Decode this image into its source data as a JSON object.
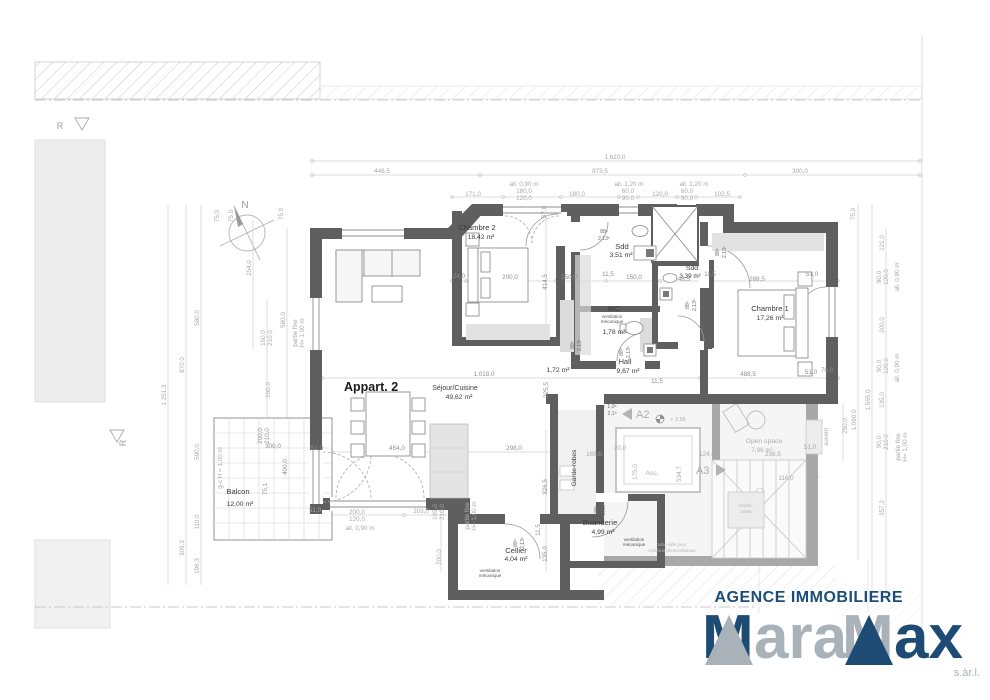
{
  "branding": {
    "agency": "AGENCE IMMOBILIERE",
    "logo_m1": "M",
    "logo_mid": "ara",
    "logo_m2": "M",
    "logo_end": "ax",
    "suffix": "s.àr.l.",
    "navy": "#1d4b74",
    "silver": "#a9b2b9"
  },
  "colors": {
    "wall": "#5f5f5f",
    "common_wall": "#a3a3a3",
    "dim_text": "#a9a9a9",
    "accent_navy": "#1c4d78"
  },
  "compass": {
    "north": "N"
  },
  "site": {
    "r_marker1": "R",
    "r_marker2": "R"
  },
  "rooms": {
    "apartment": "Appart. 2",
    "sejour": {
      "name": "Séjour/Cuisine",
      "area": "49,62 m²"
    },
    "chambre2": {
      "name": "Chambre 2",
      "area": "18,42 m²"
    },
    "sdd1": {
      "name": "Sdd",
      "area": "3,51 m²"
    },
    "sdd2": {
      "name": "Sdd",
      "area": "3,39 m²"
    },
    "wc": {
      "name": "WC",
      "area": "1,78 m²",
      "note1": "ventilation",
      "note2": "mécanique"
    },
    "hall": {
      "name": "Hall",
      "area": "9,67 m²"
    },
    "small": {
      "area": "1,72 m²"
    },
    "chambre1": {
      "name": "Chambre 1",
      "area": "17,26 m²"
    },
    "balcon": {
      "name": "Balcon",
      "area": "12,00 m²"
    },
    "garde": {
      "name": "Garde-robes"
    },
    "buanderie": {
      "name": "Buanderie",
      "area": "4,99 m²",
      "note1": "ventilation",
      "note2": "mécanique"
    },
    "cellier": {
      "name": "Cellier",
      "area": "4,04 m²",
      "note1": "ventilation",
      "note2": "mécanique"
    },
    "open_space": {
      "name": "Open space",
      "area": "7,96 m²"
    },
    "asc": "Asc.",
    "garde2a": "Garde-",
    "garde2b": "robes",
    "auvent": "auvent",
    "level": "+ 2,95",
    "marker_a2": "A2",
    "marker_a3": "A3",
    "photo1": "tube vide pour",
    "photo2": "système photovoltaique"
  },
  "ann": {
    "w1": "88⁵",
    "h1": "2,13⁵",
    "w2": "1,0⁵",
    "h2": "2,1³"
  },
  "dims": {
    "t1": "1.620,0",
    "t2": "446,5",
    "t3": "873,5",
    "t4": "300,0",
    "t5": "all. 0,90 m",
    "t6": "180,0",
    "t7": "120,0",
    "t8": "171,0",
    "t9": "180,0",
    "t10": "all. 1,20 m",
    "t11": "60,0",
    "t12": "90,0",
    "t13": "120,0",
    "t14": "all. 1,20 m",
    "t15": "60,0",
    "t16": "90,0",
    "t17": "102,5",
    "l1": "75,0",
    "l2": "75,0",
    "l3": "75,0",
    "l4": "1.251,3",
    "l5": "870,0",
    "l6": "580,0",
    "l7": "254,0",
    "l8": "580,0",
    "l9": "160,0",
    "l10": "210,0",
    "l11": "partie fixe",
    "l12": "H= 1,00 m",
    "l13": "160,0",
    "l14": "590,0",
    "l15": "110,0",
    "l16": "306,3",
    "l17": "196,3",
    "b1": "300,0",
    "b2": "200,0",
    "b3": "210,0",
    "b4": "400,0",
    "b5": "75,1",
    "b6": "51,0",
    "b7": "g-c H = 1,00 m",
    "b8": "51,0",
    "b9": "200,0",
    "b10": "120,0",
    "b11": "all. 0,90 m",
    "m1": "24,0",
    "m2": "200,0",
    "m3": "414,5",
    "m4": "250,0",
    "m5": "11,5",
    "m6": "150,0",
    "m7": "48,5",
    "m8": "11,5",
    "m9": "288,5",
    "m10": "51,0",
    "m11": "70,0",
    "m12": "57,0",
    "m13": "1.018,0",
    "m14": "225,5",
    "m15": "488,5",
    "m16": "11,5",
    "g1": "454,0",
    "g2": "298,0",
    "g3": "165,0",
    "g4": "20,0",
    "g5": "124,0",
    "g6": "236,5",
    "g7": "51,0",
    "g8": "116,0",
    "g9": "175,0",
    "g10": "534,7",
    "g11": "250,0",
    "g12": "326,5",
    "g13": "11,5",
    "g14": "135,0",
    "g15": "203,0",
    "g16": "105,0",
    "g17": "210,0",
    "g18": "200,0",
    "g19": "partie fixe",
    "g20": "H= 1,00 m",
    "r1": "75,0",
    "r2": "121,0",
    "r3": "90,0",
    "r4": "120,0",
    "r5": "all. 0,90 m",
    "r6": "200,0",
    "r7": "90,0",
    "r8": "120,0",
    "r9": "all. 0,90 m",
    "r10": "135,0",
    "r11": "90,0",
    "r12": "210,0",
    "r13": "partie fixe",
    "r14": "H= 1,00 m",
    "r15": "357,2",
    "r16": "1.565,0",
    "r17": "1.090,0"
  }
}
